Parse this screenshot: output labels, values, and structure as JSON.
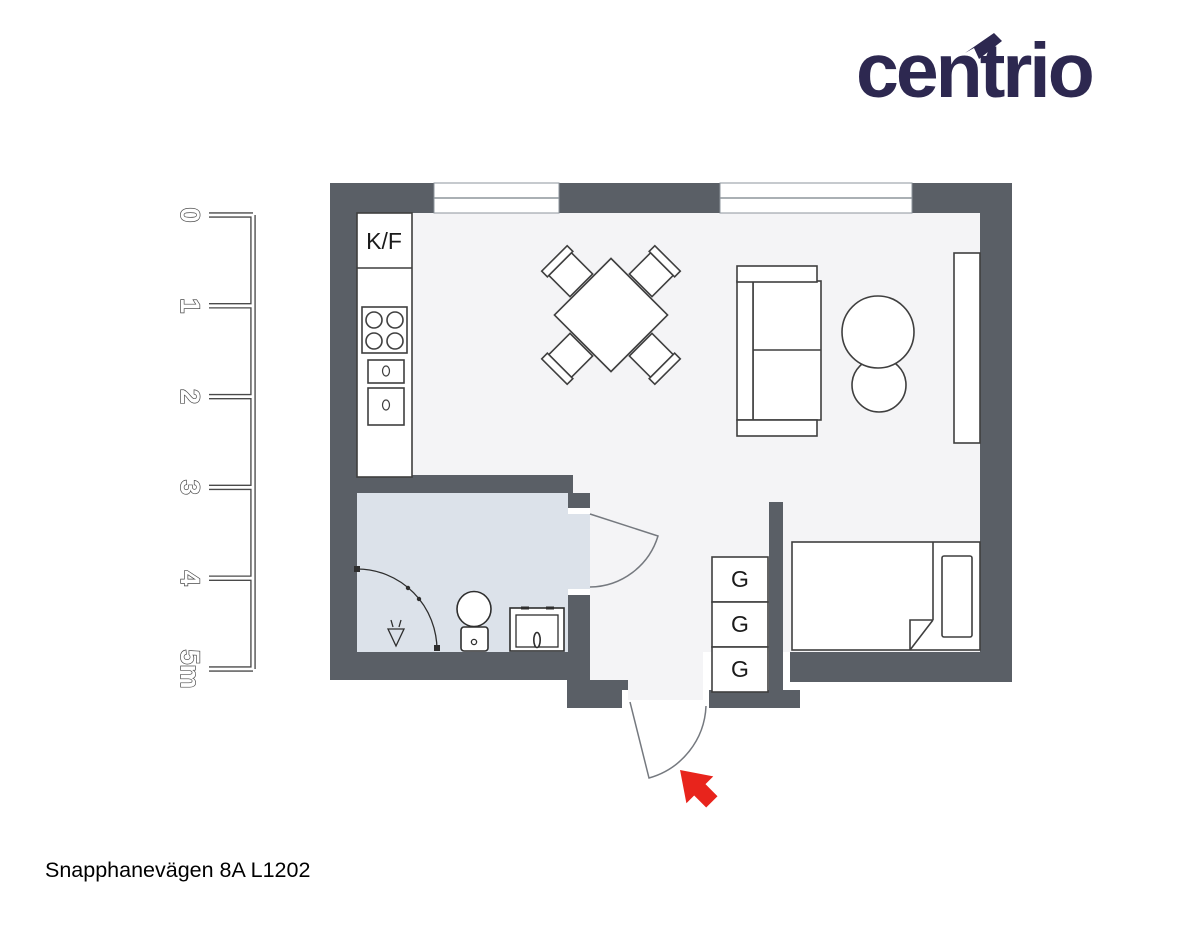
{
  "logo": {
    "pre": "cen",
    "t": "t",
    "post": "rio",
    "color": "#2d2850"
  },
  "scale_bar": {
    "labels": [
      "0",
      "1",
      "2",
      "3",
      "4",
      "5m"
    ]
  },
  "plan": {
    "kitchen": {
      "fridge_label": "K/F"
    },
    "closets": {
      "labels": [
        "G",
        "G",
        "G"
      ]
    },
    "colors": {
      "wall": "#5a5f66",
      "floor": "#f4f4f6",
      "bathroom_floor": "#dce2ea",
      "arrow": "#e8241c"
    }
  },
  "footer": {
    "address": "Snapphanevägen 8A L1202"
  }
}
